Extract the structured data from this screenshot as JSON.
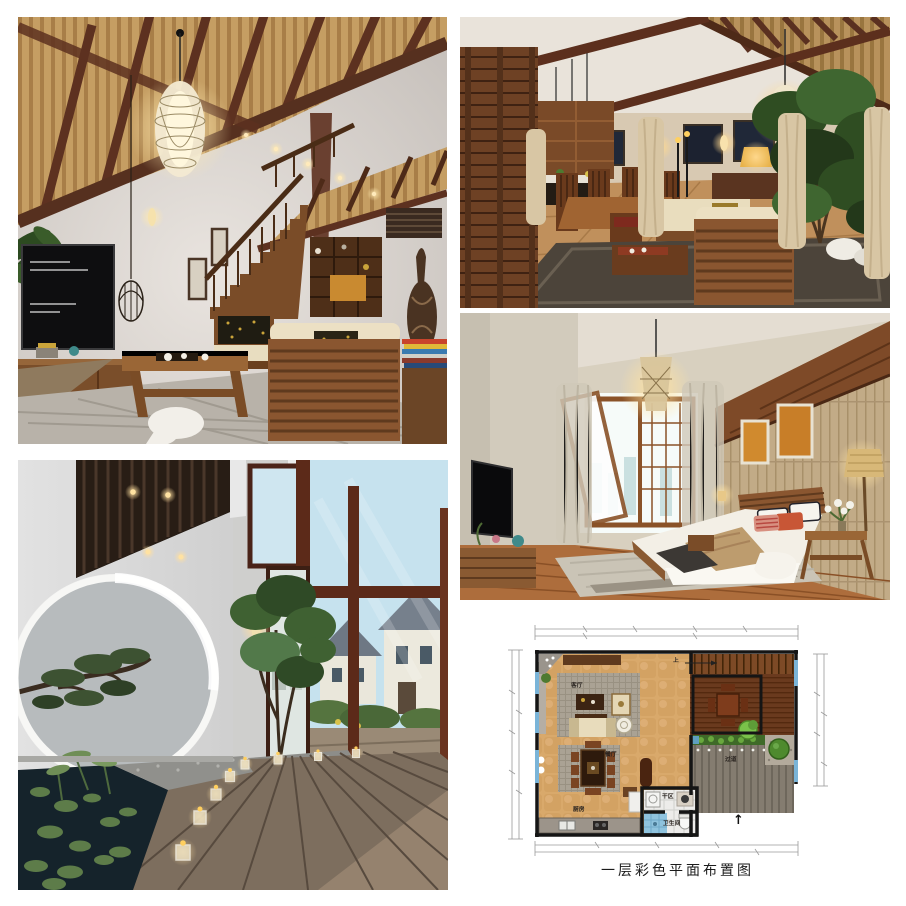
{
  "page": {
    "background": "#ffffff",
    "layout": "five-panel interior design collage"
  },
  "panels": [
    {
      "id": "living-room-loft",
      "accent_colors": {
        "beam": "#5d3120",
        "ceiling_wood": "#c59e63",
        "wall": "#d5cfca",
        "sofa_wood": "#8a5630"
      }
    },
    {
      "id": "great-room-dining",
      "accent_colors": {
        "wall": "#d8cab4",
        "rug": "#4c443a",
        "floor": "#c0905c",
        "screen": "#6e4124"
      }
    },
    {
      "id": "bedroom",
      "accent_colors": {
        "plank_wall": "#c2ab87",
        "band": "#7e4a28",
        "pillow_orange": "#c85636",
        "floor": "#ad6d3c"
      }
    },
    {
      "id": "courtyard-corridor",
      "accent_colors": {
        "wall": "#d2d2d2",
        "pond": "#15232b",
        "deck": "#7d6e5e",
        "window_frame": "#5c2a19"
      }
    },
    {
      "id": "floor-plan",
      "accent_colors": {
        "tile": "#d9a96b",
        "wall_line": "#151515",
        "window_blue": "#7ab4d8",
        "deck_grey": "#847c70"
      }
    }
  ],
  "floorplan": {
    "caption": "一层彩色平面布置图",
    "labels": {
      "living": "客厅",
      "dining": "餐厅",
      "kitchen": "厨房",
      "dry_area": "干区",
      "bathroom": "卫生间",
      "corridor": "过道",
      "stairs_up": "上",
      "entry_arrow": "↑"
    }
  }
}
